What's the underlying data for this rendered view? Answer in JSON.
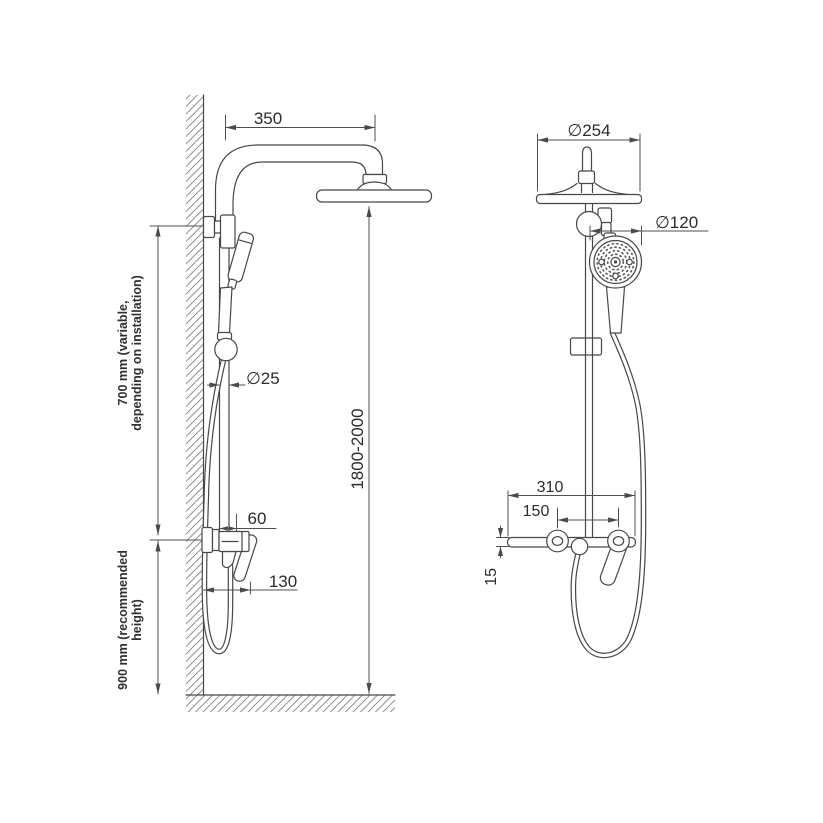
{
  "page": {
    "background": "#ffffff",
    "line_color": "#474747",
    "text_color": "#2b2b2b"
  },
  "side_view": {
    "dim_arm_length": "350",
    "dim_pipe_diameter": "∅25",
    "dim_total_height": "1800-2000",
    "dim_upper_height_line1": "700 mm (variable,",
    "dim_upper_height_line2": "depending on installation)",
    "dim_lower_height_line1": "900 mm (recommended",
    "dim_lower_height_line2": "height)",
    "dim_mixer_offset": "60",
    "dim_mixer_depth": "130"
  },
  "front_view": {
    "dim_head_diameter": "∅254",
    "dim_hand_shower_diameter": "∅120",
    "dim_body_width": "310",
    "dim_inlet_spacing": "150",
    "dim_shelf_thickness": "15"
  }
}
